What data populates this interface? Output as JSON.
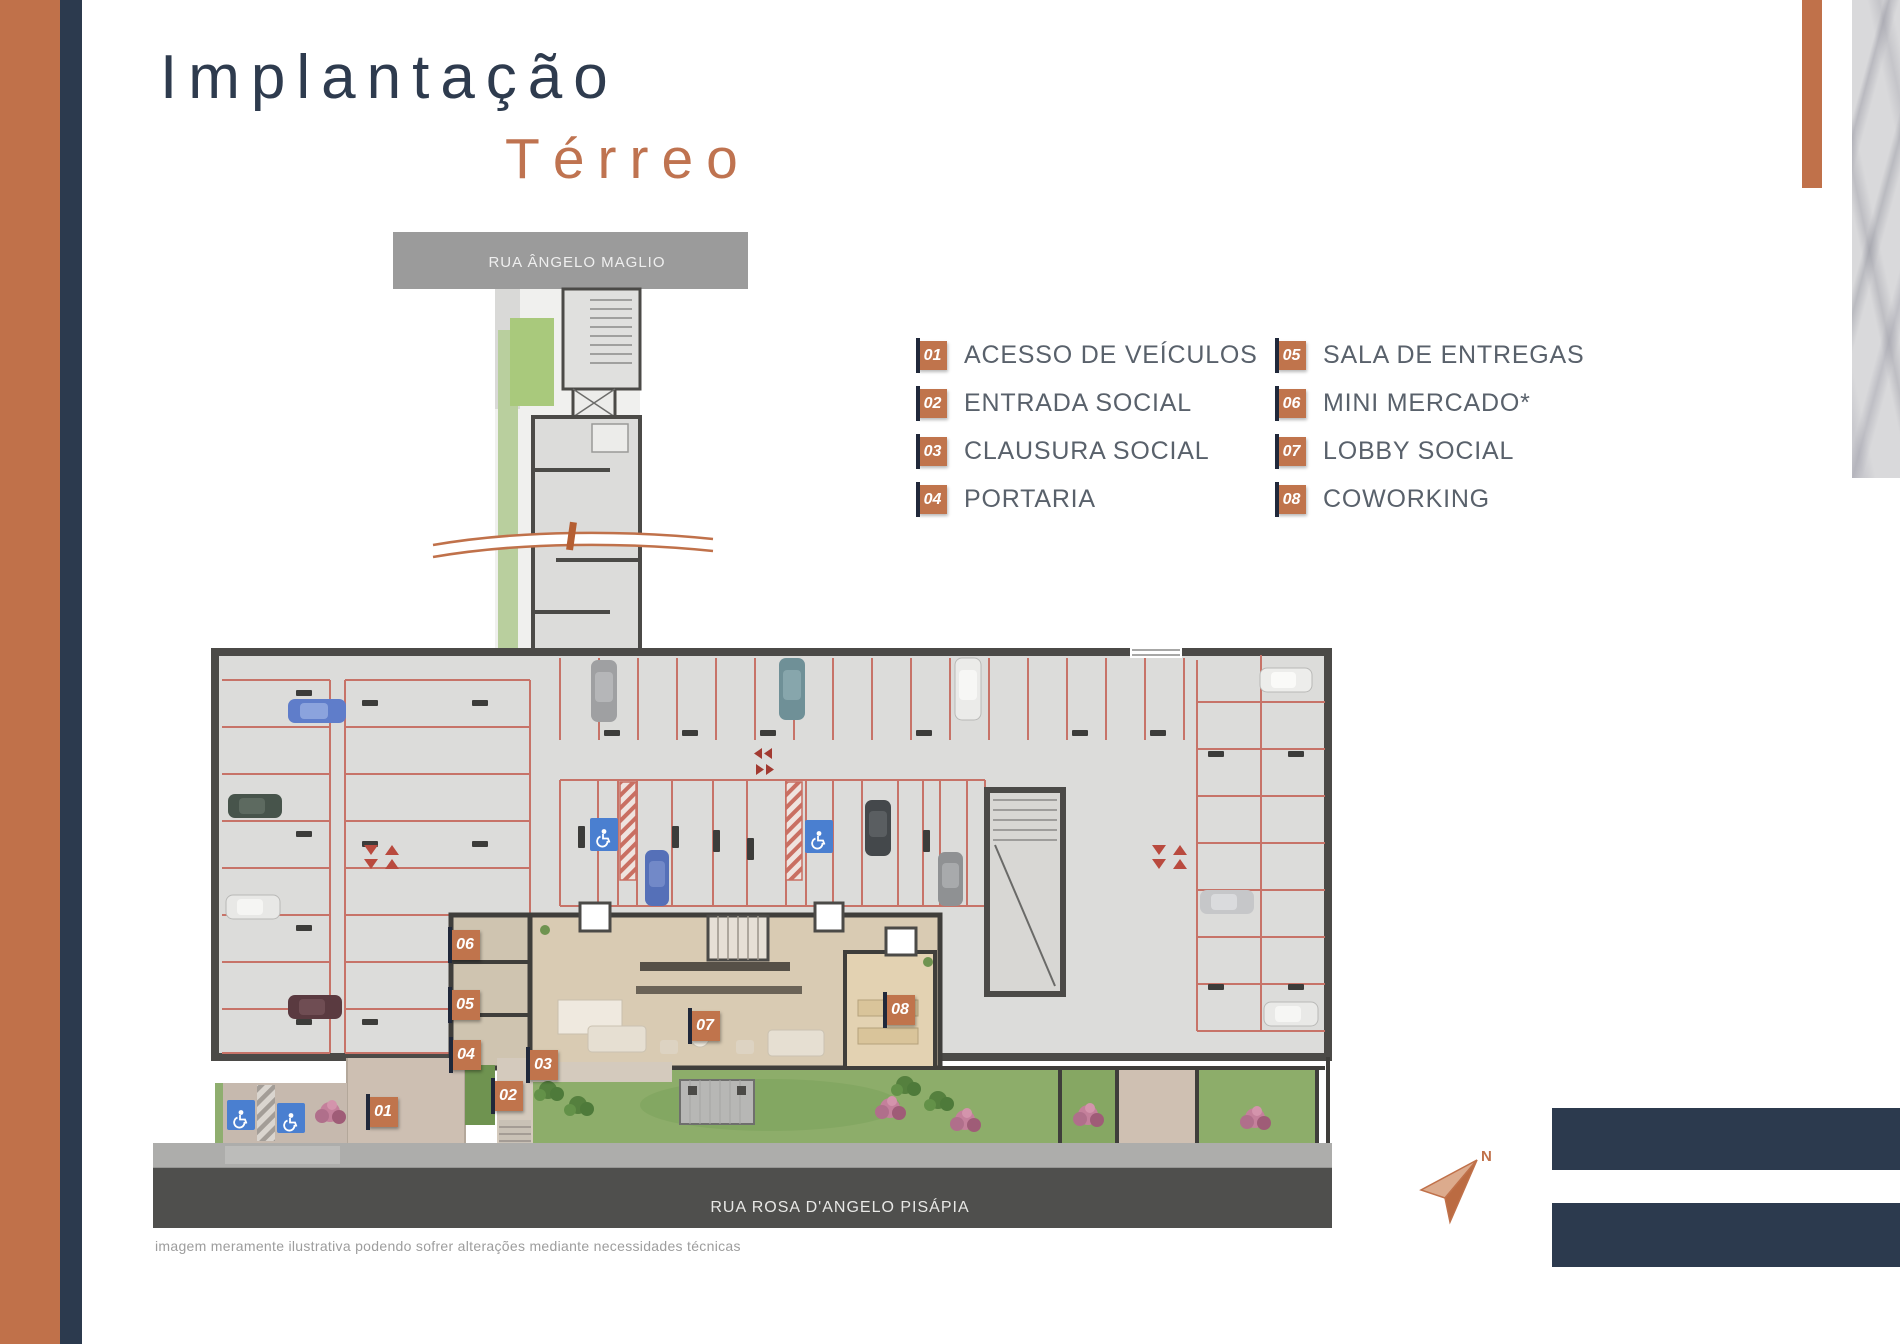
{
  "page": {
    "title_line1": "Implantação",
    "title_line2": "Térreo",
    "disclaimer": "imagem meramente ilustrativa podendo sofrer alterações mediante necessidades técnicas"
  },
  "legend": {
    "col1": [
      {
        "num": "01",
        "label": "ACESSO DE VEÍCULOS"
      },
      {
        "num": "02",
        "label": "ENTRADA SOCIAL"
      },
      {
        "num": "03",
        "label": "CLAUSURA SOCIAL"
      },
      {
        "num": "04",
        "label": "PORTARIA"
      }
    ],
    "col2": [
      {
        "num": "05",
        "label": "SALA DE ENTREGAS"
      },
      {
        "num": "06",
        "label": "MINI MERCADO*"
      },
      {
        "num": "07",
        "label": "LOBBY SOCIAL"
      },
      {
        "num": "08",
        "label": "COWORKING"
      }
    ]
  },
  "plan": {
    "street_top": "RUA ÂNGELO MAGLIO",
    "street_bottom": "RUA ROSA D'ANGELO PISÁPIA",
    "north_label": "N",
    "badges": [
      {
        "num": "01"
      },
      {
        "num": "02"
      },
      {
        "num": "03"
      },
      {
        "num": "04"
      },
      {
        "num": "05"
      },
      {
        "num": "06"
      },
      {
        "num": "07"
      },
      {
        "num": "08"
      }
    ]
  },
  "colors": {
    "accent_terracotta": "#c0714a",
    "navy": "#2c3a4e",
    "legend_text": "#59616b",
    "badge_orange": "#c0744c",
    "stall_red": "#c77368",
    "handicap_blue": "#4a7fd0",
    "lawn_green": "#8dad6a",
    "street_band_gray": "#9b9b9b",
    "street_band_dark": "#4e4e4c"
  }
}
